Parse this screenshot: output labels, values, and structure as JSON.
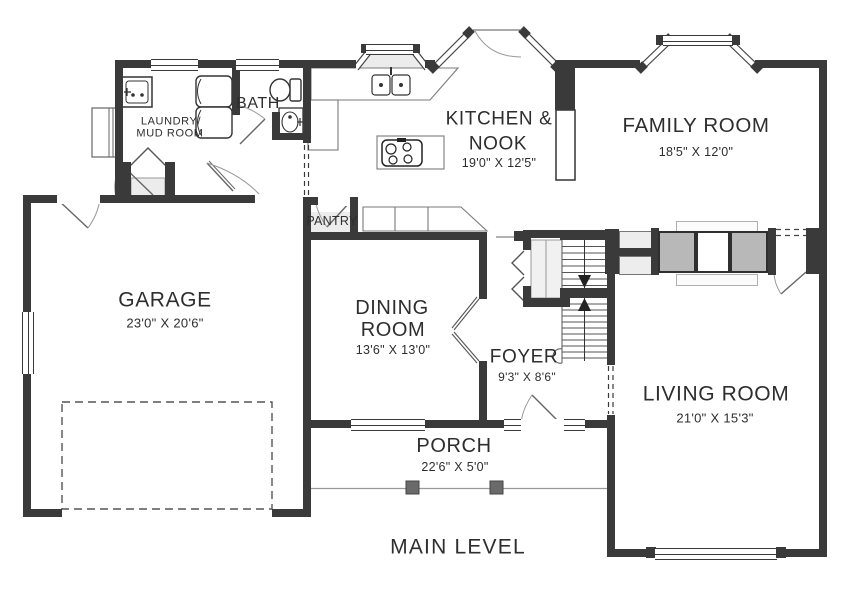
{
  "title": "MAIN LEVEL",
  "rooms": {
    "garage": {
      "name": "GARAGE",
      "dims": "23'0\" X 20'6\""
    },
    "laundry_mud": {
      "line1": "LAUNDRY/",
      "line2": "MUD ROOM"
    },
    "bath": {
      "name": "BATH"
    },
    "pantry": {
      "name": "PANTRY"
    },
    "kitchen_nook": {
      "line1": "KITCHEN &",
      "line2": "NOOK",
      "dims": "19'0\" X 12'5\""
    },
    "family": {
      "name": "FAMILY ROOM",
      "dims": "18'5\" X 12'0\""
    },
    "dining": {
      "line1": "DINING",
      "line2": "ROOM",
      "dims": "13'6\" X 13'0\""
    },
    "foyer": {
      "name": "FOYER",
      "dims": "9'3\" X 8'6\""
    },
    "living": {
      "name": "LIVING ROOM",
      "dims": "21'0\" X 15'3\""
    },
    "porch": {
      "name": "PORCH",
      "dims": "22'6\" X 5'0\""
    }
  },
  "colors": {
    "wall": "#3a3a3a",
    "text": "#2e2e2e",
    "fixture_gray": "#ececec",
    "fireplace_gray": "#b8b8b8"
  }
}
